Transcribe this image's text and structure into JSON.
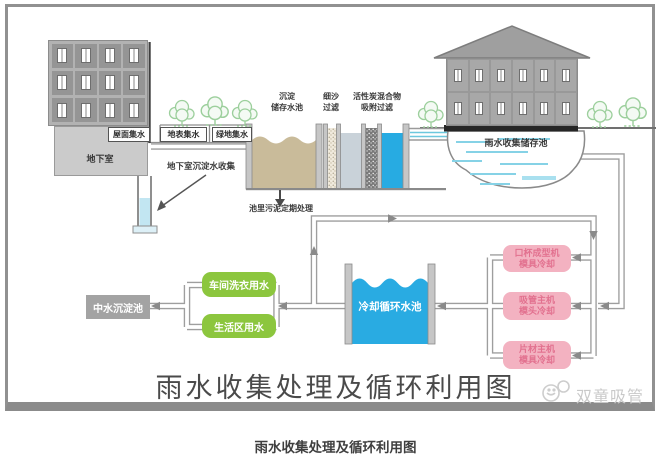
{
  "page": {
    "caption": "雨水收集处理及循环利用图"
  },
  "diagram": {
    "title": "雨水收集处理及循环利用图",
    "watermark": "双童吸管",
    "collection": {
      "roof": "屋面集水",
      "surface": "地表集水",
      "greenland": "绿地集水",
      "basement": "地下室",
      "basement_sediment": "地下室沉淀水收集"
    },
    "treatment": {
      "sediment_storage": [
        "沉淀",
        "储存水池"
      ],
      "sand_filter": [
        "细沙",
        "过滤"
      ],
      "carbon_filter": [
        "活性炭混合物",
        "吸附过滤"
      ],
      "sludge_note": "池里污泥定期处理"
    },
    "storage_pool": "雨水收集储存池",
    "flow": {
      "reclaimed_pool": "中水沉淀池",
      "laundry": "车间洗衣用水",
      "living": "生活区用水",
      "cooling_pool": "冷却循环水池",
      "cup_machine": [
        "口杯成型机",
        "模具冷却"
      ],
      "straw_machine": [
        "吸管主机",
        "模头冷却"
      ],
      "sheet_machine": [
        "片材主机",
        "模具冷却"
      ]
    },
    "colors": {
      "water_blue": "#29abe2",
      "reuse_green": "#8cc63e",
      "machine_pink": "#f3b2c1",
      "machine_pink_text": "#e2718f",
      "sediment_tan": "#c9bb9a",
      "pipe_gray": "#9e9e9e",
      "building_gray": "#a8a8a8"
    }
  }
}
